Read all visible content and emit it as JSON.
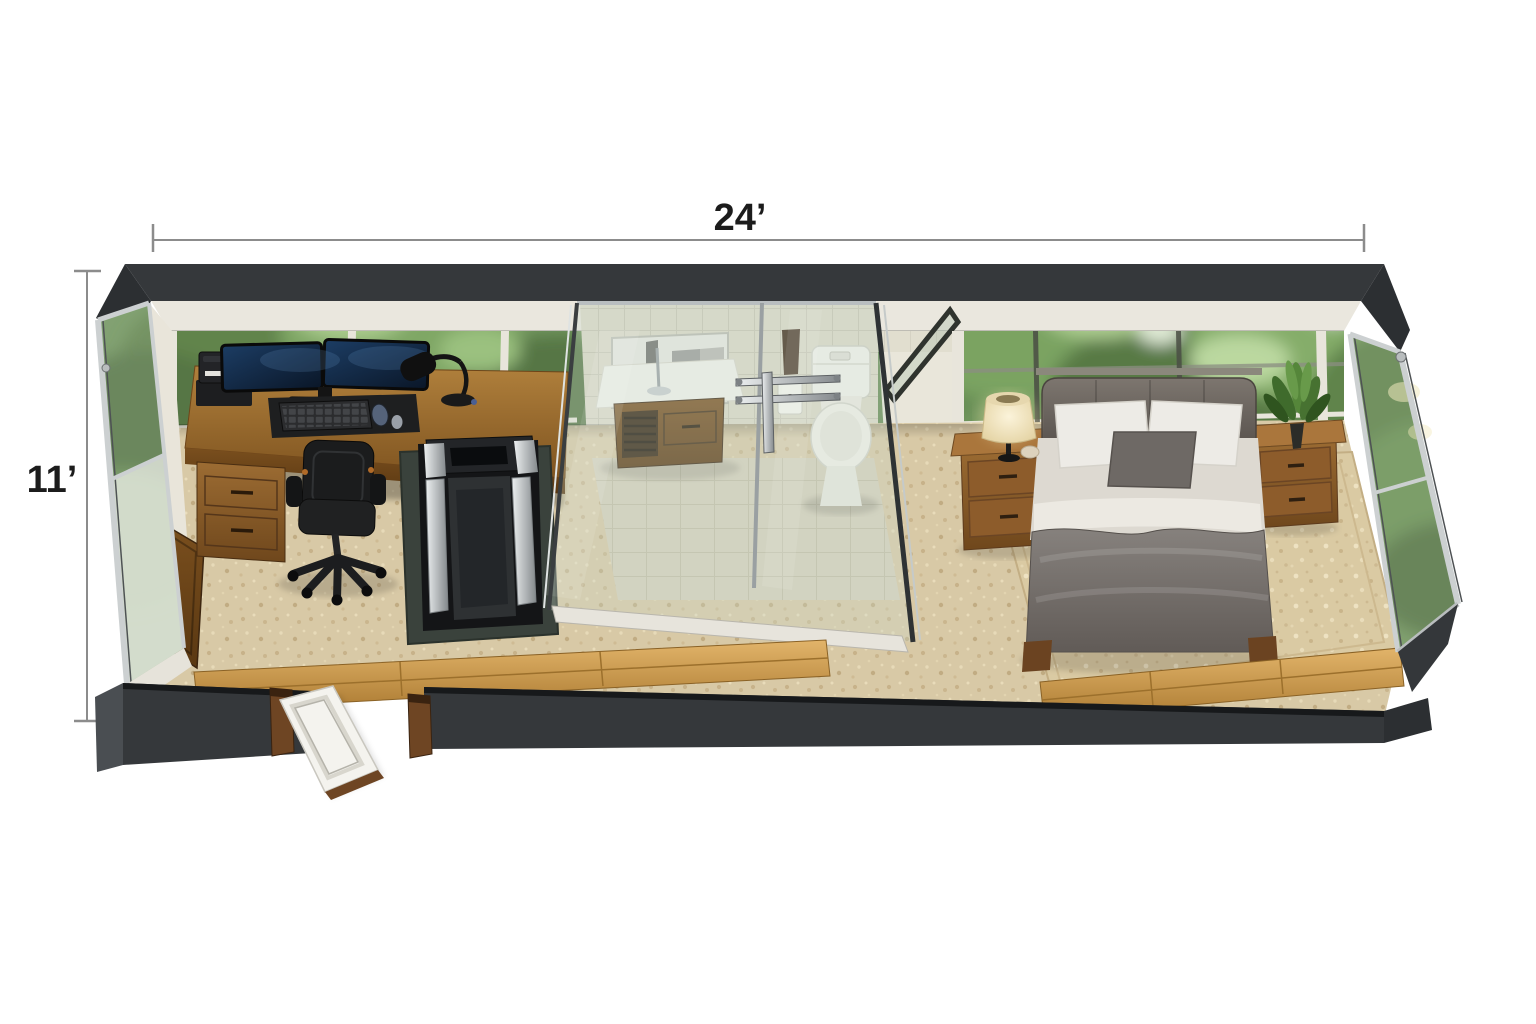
{
  "annotations": {
    "width_label": "24’",
    "height_label": "11’"
  },
  "palette": {
    "background": "#ffffff",
    "dimension_line": "#8c8c8c",
    "dimension_text": "#1c1c1c",
    "wall_dark": "#35383b",
    "wall_trim": "#eae7de",
    "carpet": "#d8c9a6",
    "rug": "#dacaa3",
    "tile_wall": "#dbd8c8",
    "tile_floor": "#d6d0bc",
    "wood_floor": "#d9ab5f",
    "desk_wood": "#a87734",
    "glass_tint": "rgba(203,218,204,0.30)",
    "foliage_base": "#5c8544",
    "duvet_gray": "#7b7672",
    "fixture_white": "#f3f2ec"
  }
}
